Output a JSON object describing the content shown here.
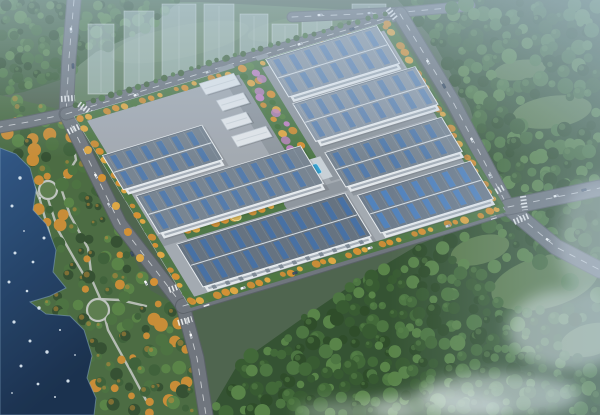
{
  "scene": {
    "kind": "aerial-architectural-rendering",
    "canvas": {
      "width": 600,
      "height": 415
    },
    "palette": {
      "base": "#4a5f46",
      "road": "#6d7279",
      "road_edge": "#565b62",
      "lane": "#ffffff",
      "ground": "#a4a9b0",
      "inner_road": "#8f959c",
      "fence": "#c9cfd5",
      "buffer_green": "#47703a",
      "field": "#5e7b57",
      "field_light": "#6f8c63",
      "park": "#46673a",
      "path": "#c3c6c0",
      "water_top": "#2a5181",
      "water_bottom": "#122846",
      "speck": "#e9f3fb",
      "shore": "#7fa3c0",
      "forest_base": "#2e4c28",
      "tree_greens": [
        "#27451f",
        "#315427",
        "#3c642f",
        "#477238",
        "#548040"
      ],
      "park_greens": [
        "#2f4a28",
        "#3a5c31",
        "#486e38",
        "#55813f",
        "#cc8a2e"
      ],
      "street_mix": [
        "#d98e2b",
        "#e2a63c",
        "#4a7439",
        "#cc8a2e"
      ],
      "garden_mix": [
        "#d98e2b",
        "#3e6b2f",
        "#e2a63c",
        "#55813f",
        "#bf7fc0",
        "#cc8a2e",
        "#4a7439"
      ],
      "flower": "#c27fc4",
      "ghost_fill": "rgba(224,236,247,0.42)",
      "ghost_stroke": "rgba(255,255,255,0.55)",
      "pool": "#2f9fd0",
      "pool_rim": "#bfe1f0",
      "deck": "#ccd2d8",
      "dome": "#d9b452",
      "dome_rim": "#f0df9f",
      "wall": "#e8ebee",
      "window": "#9aa3ad",
      "small_roof": "#e6e9ec",
      "small_edge": "#c2c8cf",
      "ridge": "#d8dee4",
      "eave": "#eef1f4",
      "shadow": "#000000",
      "haze": "#bcd2e6",
      "mist": "#f2f7fb"
    },
    "roof_styles": {
      "A": {
        "base": "#76828f",
        "seam": "#8d98a4",
        "sky": "#4c77ad"
      },
      "B": {
        "base": "#8b96a4",
        "seam": "#9fa9b5",
        "sky": "#5c82b2"
      },
      "C": {
        "base": "#626e7c",
        "seam": "#79848f",
        "sky": "#3f6ba6"
      },
      "D": {
        "base": "#6b7888",
        "seam": "#828e9a",
        "sky": "#4a80c2"
      }
    },
    "field_poly": [
      [
        78,
        2
      ],
      [
        200,
        2
      ],
      [
        388,
        12
      ],
      [
        300,
        50
      ],
      [
        66,
        110
      ]
    ],
    "field_patches": [
      [
        180,
        42,
        70,
        16,
        -12
      ],
      [
        295,
        28,
        48,
        11,
        -10
      ]
    ],
    "forest_right_poly": [
      [
        398,
        0
      ],
      [
        600,
        0
      ],
      [
        600,
        415
      ],
      [
        208,
        415
      ],
      [
        238,
        364
      ],
      [
        300,
        320
      ],
      [
        356,
        282
      ],
      [
        420,
        244
      ],
      [
        470,
        224
      ],
      [
        500,
        210
      ],
      [
        470,
        108
      ],
      [
        430,
        36
      ]
    ],
    "forest_meadows": [
      [
        552,
        112,
        40,
        16,
        -8
      ],
      [
        520,
        70,
        26,
        10,
        -8
      ],
      [
        545,
        282,
        55,
        26,
        -15
      ],
      [
        590,
        340,
        30,
        16,
        -15
      ],
      [
        480,
        250,
        30,
        14,
        -15
      ]
    ],
    "forest_topleft_poly": [
      [
        0,
        0
      ],
      [
        180,
        0
      ],
      [
        150,
        28
      ],
      [
        96,
        52
      ],
      [
        60,
        80
      ],
      [
        24,
        92
      ],
      [
        0,
        96
      ]
    ],
    "park_poly": [
      [
        0,
        95
      ],
      [
        62,
        110
      ],
      [
        95,
        178
      ],
      [
        120,
        230
      ],
      [
        150,
        290
      ],
      [
        178,
        306
      ],
      [
        196,
        360
      ],
      [
        206,
        415
      ],
      [
        94,
        415
      ],
      [
        96,
        398
      ],
      [
        87,
        378
      ],
      [
        92,
        356
      ],
      [
        84,
        330
      ],
      [
        70,
        316
      ],
      [
        46,
        314
      ],
      [
        30,
        302
      ],
      [
        50,
        296
      ],
      [
        66,
        288
      ],
      [
        53,
        272
      ],
      [
        56,
        250
      ],
      [
        46,
        224
      ],
      [
        33,
        210
      ],
      [
        36,
        190
      ],
      [
        30,
        168
      ],
      [
        16,
        154
      ],
      [
        0,
        148
      ]
    ],
    "water_poly": [
      [
        0,
        148
      ],
      [
        16,
        154
      ],
      [
        30,
        168
      ],
      [
        36,
        190
      ],
      [
        33,
        210
      ],
      [
        46,
        224
      ],
      [
        56,
        250
      ],
      [
        53,
        272
      ],
      [
        66,
        288
      ],
      [
        50,
        296
      ],
      [
        30,
        302
      ],
      [
        46,
        314
      ],
      [
        70,
        316
      ],
      [
        84,
        330
      ],
      [
        92,
        356
      ],
      [
        87,
        378
      ],
      [
        96,
        398
      ],
      [
        94,
        415
      ],
      [
        0,
        415
      ]
    ],
    "water_specks": [
      [
        12,
        206
      ],
      [
        24,
        231
      ],
      [
        15,
        253
      ],
      [
        33,
        262
      ],
      [
        9,
        282
      ],
      [
        27,
        291
      ],
      [
        39,
        308
      ],
      [
        14,
        322
      ],
      [
        30,
        341
      ],
      [
        47,
        352
      ],
      [
        21,
        366
      ],
      [
        38,
        384
      ],
      [
        55,
        397
      ],
      [
        68,
        381
      ],
      [
        12,
        393
      ],
      [
        44,
        238
      ],
      [
        60,
        330
      ],
      [
        75,
        355
      ],
      [
        20,
        178
      ],
      [
        40,
        198
      ]
    ],
    "park_rings": [
      [
        48,
        190,
        9
      ],
      [
        98,
        310,
        11
      ]
    ],
    "park_paths": [
      [
        [
          70,
          126
        ],
        [
          76,
          160
        ],
        [
          60,
          185
        ],
        [
          70,
          215
        ],
        [
          88,
          248
        ],
        [
          92,
          280
        ],
        [
          100,
          298
        ],
        [
          108,
          330
        ],
        [
          130,
          370
        ],
        [
          146,
          400
        ]
      ],
      [
        [
          48,
          199
        ],
        [
          58,
          230
        ],
        [
          75,
          260
        ],
        [
          88,
          282
        ]
      ],
      [
        [
          98,
          299
        ],
        [
          120,
          300
        ],
        [
          146,
          306
        ]
      ],
      [
        [
          28,
          172
        ],
        [
          40,
          200
        ],
        [
          50,
          236
        ],
        [
          48,
          262
        ]
      ]
    ],
    "ghost_buildings": [
      [
        88,
        94,
        26,
        70
      ],
      [
        124,
        97,
        30,
        86
      ],
      [
        162,
        100,
        34,
        96
      ],
      [
        204,
        104,
        30,
        100
      ],
      [
        240,
        106,
        28,
        92
      ],
      [
        272,
        102,
        26,
        78
      ],
      [
        302,
        106,
        30,
        92
      ],
      [
        334,
        100,
        24,
        70
      ],
      [
        352,
        84,
        34,
        80
      ]
    ],
    "roads": [
      {
        "name": "road-topleft-vertical",
        "pts": [
          [
            74,
            0
          ],
          [
            69,
            58
          ],
          [
            66,
            114
          ]
        ],
        "w": 13
      },
      {
        "name": "road-left-branch",
        "pts": [
          [
            66,
            114
          ],
          [
            28,
            122
          ],
          [
            0,
            127
          ]
        ],
        "w": 11
      },
      {
        "name": "road-west",
        "pts": [
          [
            66,
            114
          ],
          [
            120,
            224
          ],
          [
            183,
            306
          ]
        ],
        "w": 13
      },
      {
        "name": "road-west-south",
        "pts": [
          [
            183,
            306
          ],
          [
            197,
            358
          ],
          [
            206,
            415
          ]
        ],
        "w": 13
      },
      {
        "name": "road-north",
        "pts": [
          [
            66,
            114
          ],
          [
            225,
            66
          ],
          [
            393,
            16
          ]
        ],
        "w": 11
      },
      {
        "name": "road-top",
        "pts": [
          [
            292,
            17
          ],
          [
            404,
            12
          ],
          [
            470,
            6
          ]
        ],
        "w": 9
      },
      {
        "name": "road-northeast",
        "pts": [
          [
            400,
            14
          ],
          [
            452,
            100
          ],
          [
            508,
            207
          ]
        ],
        "w": 13
      },
      {
        "name": "road-northeast-ext",
        "pts": [
          [
            508,
            207
          ],
          [
            556,
            247
          ],
          [
            600,
            270
          ]
        ],
        "w": 15
      },
      {
        "name": "road-south",
        "pts": [
          [
            183,
            306
          ],
          [
            298,
            272
          ],
          [
            425,
            233
          ],
          [
            508,
            207
          ]
        ],
        "w": 14
      },
      {
        "name": "road-south-ext",
        "pts": [
          [
            508,
            207
          ],
          [
            600,
            188
          ]
        ],
        "w": 15
      }
    ],
    "crosswalks": [
      [
        79,
        104,
        91,
        113
      ],
      [
        61,
        99,
        75,
        98
      ],
      [
        68,
        132,
        82,
        125
      ],
      [
        169,
        290,
        183,
        285
      ],
      [
        178,
        323,
        192,
        319
      ],
      [
        203,
        295,
        207,
        307
      ],
      [
        490,
        195,
        504,
        187
      ],
      [
        523,
        196,
        525,
        210
      ],
      [
        514,
        222,
        528,
        216
      ],
      [
        490,
        205,
        494,
        219
      ],
      [
        388,
        9,
        396,
        19
      ]
    ],
    "campus": {
      "matrix": [
        0.955,
        -0.29,
        0.52,
        0.854,
        66,
        114
      ],
      "ground": [
        6,
        5,
        330,
        221
      ],
      "inner_roads": [
        [
          8,
          148,
          200,
          12
        ],
        [
          158,
          0,
          16,
          146
        ],
        [
          198,
          0,
          12,
          146
        ],
        [
          210,
          102,
          124,
          12
        ],
        [
          210,
          158,
          124,
          9
        ]
      ],
      "buffers": [
        [
          6,
          5,
          330,
          8
        ],
        [
          6,
          219,
          330,
          10
        ],
        [
          6,
          5,
          9,
          221
        ],
        [
          326,
          5,
          12,
          218
        ]
      ],
      "buffer_tree_rows": [
        {
          "from": [
            10,
            9
          ],
          "to": [
            330,
            9
          ],
          "step": 9,
          "r": 2.8,
          "mixIdx": 2
        },
        {
          "from": [
            10,
            224
          ],
          "to": [
            330,
            224
          ],
          "step": 8.5,
          "r": 3.2,
          "mixIdx": 0
        },
        {
          "from": [
            9,
            10
          ],
          "to": [
            9,
            222
          ],
          "step": 9,
          "r": 3.0,
          "mixIdx": 0
        },
        {
          "from": [
            332,
            8
          ],
          "to": [
            332,
            220
          ],
          "step": 8,
          "r": 3.2,
          "mixIdx": 0
        }
      ],
      "warehouses": [
        {
          "name": "warehouse-nw-1",
          "u": 10,
          "v": 52,
          "L": 104,
          "W": 40,
          "style": "A"
        },
        {
          "name": "warehouse-nw-2",
          "u": 18,
          "v": 102,
          "L": 172,
          "W": 44,
          "style": "A"
        },
        {
          "name": "warehouse-ne-1",
          "u": 206,
          "v": 6,
          "L": 116,
          "W": 44,
          "style": "B"
        },
        {
          "name": "warehouse-ne-2",
          "u": 206,
          "v": 58,
          "L": 128,
          "W": 44,
          "style": "B"
        },
        {
          "name": "warehouse-e",
          "u": 208,
          "v": 116,
          "L": 122,
          "W": 40,
          "style": "A"
        },
        {
          "name": "warehouse-south-big",
          "u": 28,
          "v": 162,
          "L": 176,
          "W": 50,
          "style": "C",
          "docks": true
        },
        {
          "name": "warehouse-south-east",
          "u": 214,
          "v": 168,
          "L": 118,
          "W": 44,
          "style": "D"
        }
      ],
      "small_buildings": [
        [
          134,
          10,
          36,
          13
        ],
        [
          140,
          32,
          28,
          12
        ],
        [
          134,
          52,
          26,
          12
        ],
        [
          134,
          72,
          36,
          12
        ]
      ],
      "garden_band": [
        174,
        4,
        24,
        114
      ],
      "garden_tree_cols": [
        179,
        190
      ],
      "garden_tree_span": [
        8,
        114,
        8.5
      ],
      "flowers": [
        [
          183,
          36
        ],
        [
          186,
          62
        ],
        [
          180,
          92
        ],
        [
          192,
          24
        ]
      ],
      "pool_deck": [
        172,
        118,
        30,
        24
      ],
      "pool": [
        178,
        124,
        17,
        11
      ],
      "dome_band": [
        40,
        144,
        104,
        16
      ],
      "dome": [
        95,
        152,
        5
      ]
    },
    "cars": [
      [
        71,
        30,
        87,
        "#ffffff"
      ],
      [
        73,
        66,
        87,
        "#30405a"
      ],
      [
        96,
        176,
        62,
        "#ffffff"
      ],
      [
        109,
        205,
        62,
        "#cfd4da"
      ],
      [
        132,
        254,
        63,
        "#374a60"
      ],
      [
        146,
        283,
        63,
        "#ffffff"
      ],
      [
        191,
        336,
        78,
        "#ffffff"
      ],
      [
        136,
        95,
        -17,
        "#ffffff"
      ],
      [
        208,
        72,
        -17,
        "#d2d7dc"
      ],
      [
        300,
        44,
        -17,
        "#ffffff"
      ],
      [
        352,
        29,
        -17,
        "#44536a"
      ],
      [
        320,
        15,
        -4,
        "#ffffff"
      ],
      [
        370,
        13,
        -4,
        "#ccd1d8"
      ],
      [
        428,
        62,
        62,
        "#ffffff"
      ],
      [
        444,
        86,
        62,
        "#2f3f55"
      ],
      [
        472,
        140,
        64,
        "#ffffff"
      ],
      [
        490,
        176,
        64,
        "#d0d5da"
      ],
      [
        548,
        240,
        35,
        "#ffffff"
      ],
      [
        243,
        288,
        -17,
        "#ffffff"
      ],
      [
        295,
        273,
        -17,
        "#3a4c62"
      ],
      [
        370,
        248,
        -16,
        "#ffffff"
      ],
      [
        448,
        226,
        -14,
        "#d4d8dd"
      ],
      [
        556,
        196,
        -11,
        "#ffffff"
      ],
      [
        584,
        190,
        -11,
        "#31415a"
      ]
    ],
    "hedge_row": {
      "from": [
        75,
        106
      ],
      "mid": [
        226,
        58
      ],
      "to": [
        385,
        14
      ],
      "step": 9,
      "r": 2.6
    },
    "overhang_trees": [
      [
        452,
        8,
        7
      ],
      [
        466,
        4,
        8
      ],
      [
        474,
        14,
        6
      ],
      [
        540,
        262,
        8
      ],
      [
        570,
        282,
        9
      ],
      [
        598,
        295,
        8
      ],
      [
        585,
        240,
        7
      ],
      [
        88,
        150,
        4
      ],
      [
        102,
        178,
        4
      ],
      [
        116,
        206,
        4
      ],
      [
        128,
        232,
        4
      ],
      [
        140,
        258,
        4
      ],
      [
        154,
        282,
        4
      ]
    ],
    "mist_blobs": [
      [
        500,
        395,
        80,
        22,
        0.55
      ],
      [
        568,
        330,
        60,
        40,
        0.5
      ],
      [
        440,
        408,
        70,
        16,
        0.45
      ],
      [
        598,
        240,
        40,
        60,
        0.35
      ],
      [
        355,
        412,
        60,
        12,
        0.35
      ]
    ],
    "scatter": {
      "forest_right": {
        "step": 12,
        "rmin": 3.5,
        "rmax": 8
      },
      "forest_topleft": {
        "step": 10,
        "rmin": 3,
        "rmax": 6.5
      },
      "park": {
        "step": 13,
        "rmin": 3,
        "rmax": 7
      }
    }
  }
}
